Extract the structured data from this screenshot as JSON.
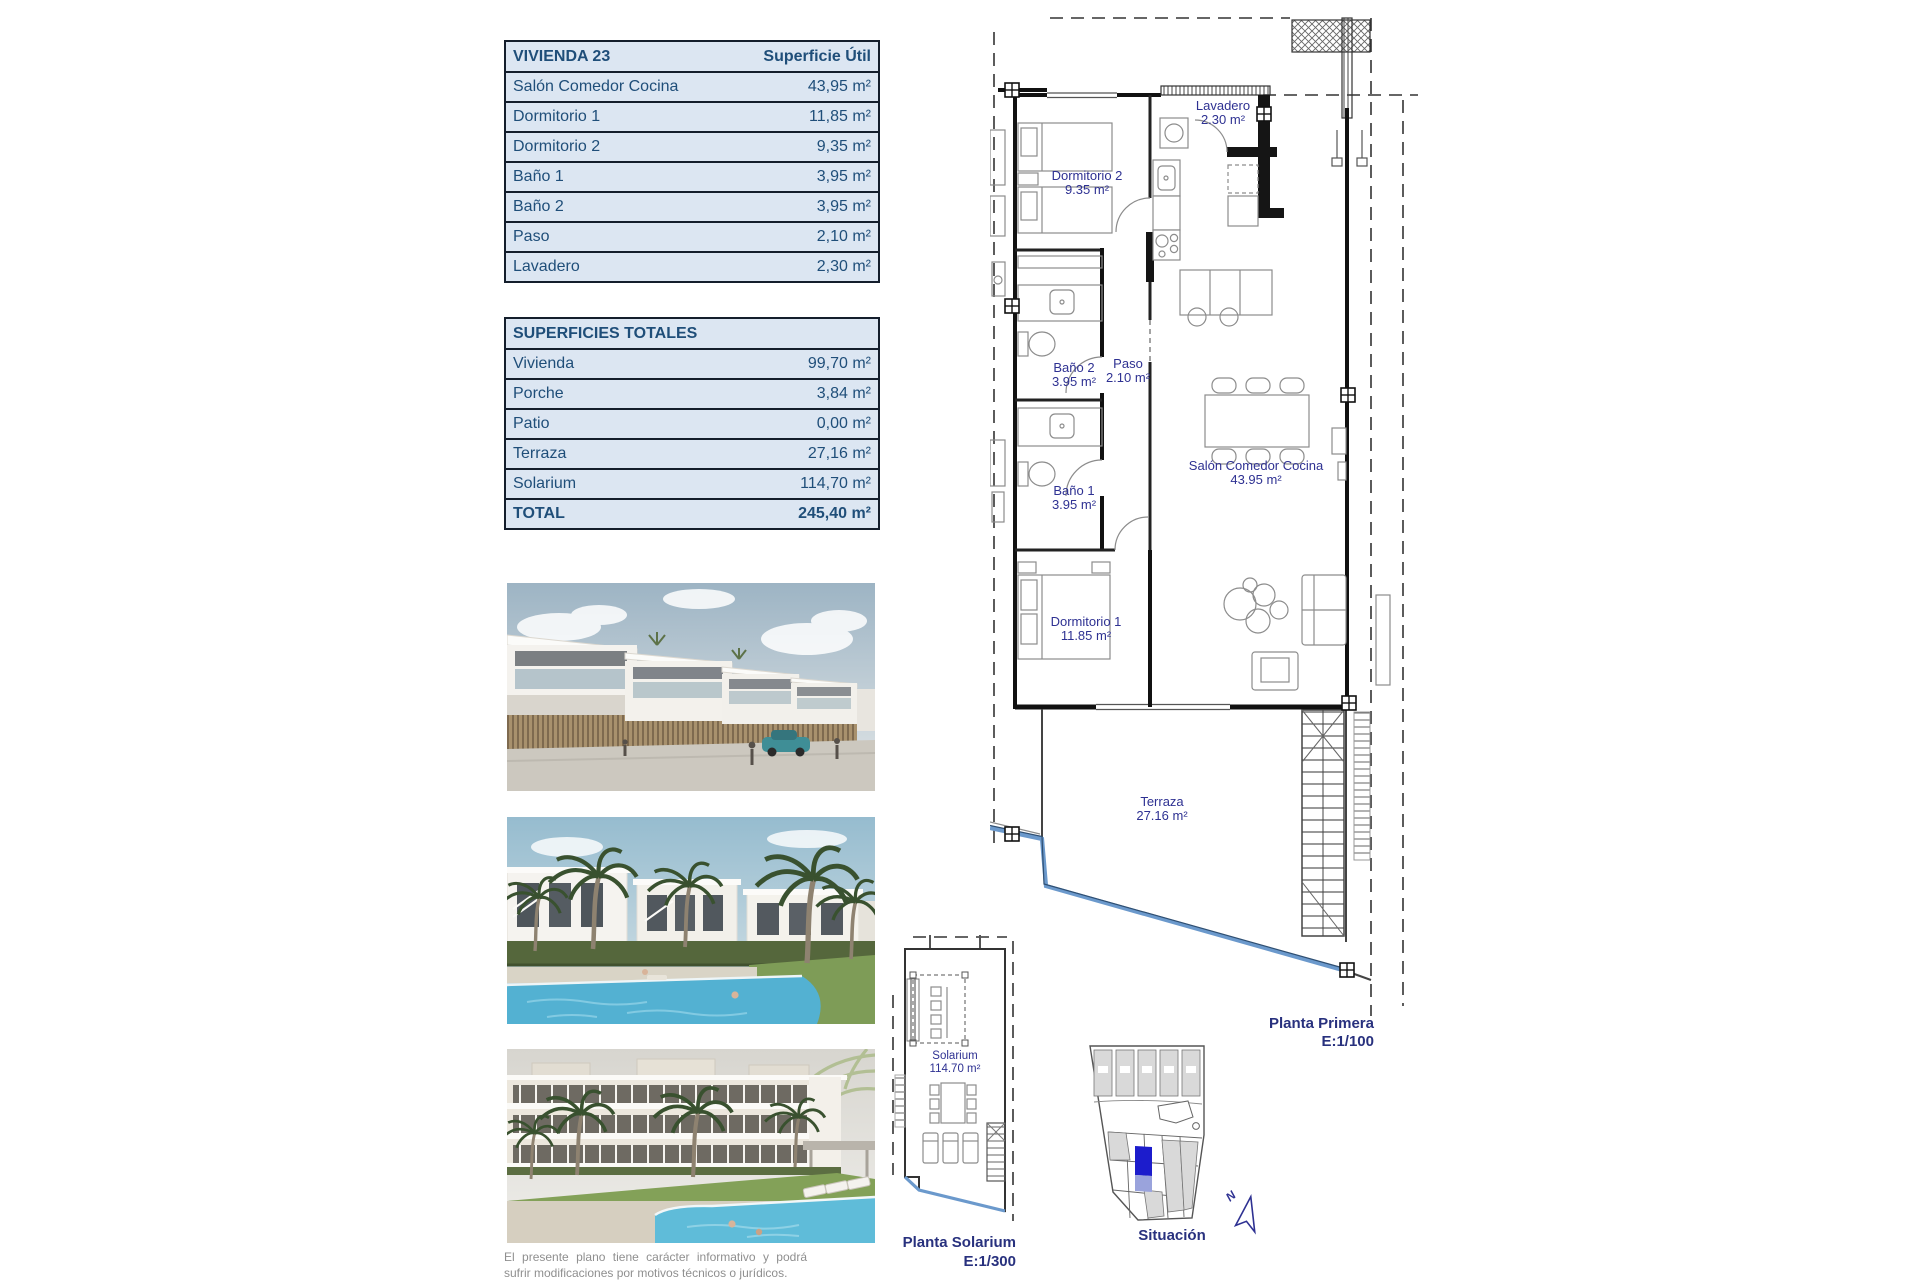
{
  "tables": {
    "vivienda": {
      "title": "VIVIENDA 23",
      "header_right": "Superficie Útil",
      "rows": [
        {
          "label": "Salón Comedor Cocina",
          "value": "43,95 m²"
        },
        {
          "label": "Dormitorio 1",
          "value": "11,85 m²"
        },
        {
          "label": "Dormitorio 2",
          "value": "9,35 m²"
        },
        {
          "label": "Baño 1",
          "value": "3,95 m²"
        },
        {
          "label": "Baño 2",
          "value": "3,95 m²"
        },
        {
          "label": "Paso",
          "value": "2,10 m²"
        },
        {
          "label": "Lavadero",
          "value": "2,30 m²"
        }
      ]
    },
    "totales": {
      "title": "SUPERFICIES TOTALES",
      "rows": [
        {
          "label": "Vivienda",
          "value": "99,70 m²"
        },
        {
          "label": "Porche",
          "value": "3,84 m²"
        },
        {
          "label": "Patio",
          "value": "0,00 m²"
        },
        {
          "label": "Terraza",
          "value": "27,16 m²"
        },
        {
          "label": "Solarium",
          "value": "114,70 m²"
        }
      ],
      "total": {
        "label": "TOTAL",
        "value": "245,40 m²"
      }
    }
  },
  "plan": {
    "rooms": {
      "dormitorio2": {
        "name": "Dormitorio 2",
        "area": "9.35 m²"
      },
      "lavadero": {
        "name": "Lavadero",
        "area": "2.30 m²"
      },
      "bano2": {
        "name": "Baño 2",
        "area": "3.95 m²"
      },
      "paso": {
        "name": "Paso",
        "area": "2.10 m²"
      },
      "bano1": {
        "name": "Baño 1",
        "area": "3.95 m²"
      },
      "salon": {
        "name": "Salón Comedor Cocina",
        "area": "43.95 m²"
      },
      "dormitorio1": {
        "name": "Dormitorio 1",
        "area": "11.85 m²"
      },
      "terraza": {
        "name": "Terraza",
        "area": "27.16 m²"
      }
    },
    "caption": {
      "line1": "Planta Primera",
      "line2": "E:1/100"
    }
  },
  "solarium": {
    "room": {
      "name": "Solarium",
      "area": "114.70 m²"
    },
    "caption": {
      "line1": "Planta Solarium",
      "line2": "E:1/300"
    }
  },
  "situacion": {
    "caption": "Situación",
    "north_label": "N"
  },
  "disclaimer": "El presente plano tiene carácter informativo y podrá sufrir modificaciones por motivos técnicos o jurídicos.",
  "colors": {
    "table_bg": "#dce6f2",
    "table_text": "#1f4e79",
    "plan_label": "#2e3192",
    "pool_edge_blue": "#6b99cc",
    "situacion_highlight": "#1c1ccc"
  }
}
